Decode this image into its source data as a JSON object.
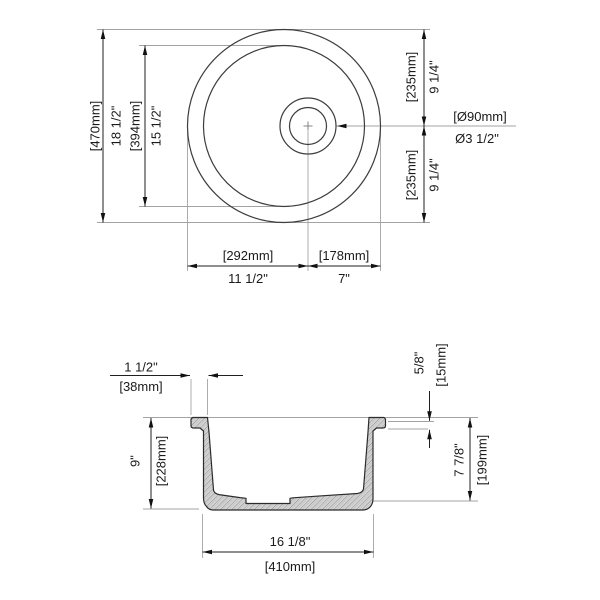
{
  "drawing_type": "sink-dimension-drawing",
  "top_view": {
    "overall_mm": "[470mm]",
    "overall_in": "18 1/2\"",
    "inner_mm": "[394mm]",
    "inner_in": "15 1/2\"",
    "upper_right_mm": "[235mm]",
    "upper_right_in": "9 1/4\"",
    "lower_right_mm": "[235mm]",
    "lower_right_in": "9 1/4\"",
    "drain_mm": "[Ø90mm]",
    "drain_in": "Ø3 1/2\"",
    "bottom_left_mm": "[292mm]",
    "bottom_left_in": "11 1/2\"",
    "bottom_right_mm": "[178mm]",
    "bottom_right_in": "7\""
  },
  "section_view": {
    "lip_in": "1 1/2\"",
    "lip_mm": "[38mm]",
    "height_in": "9\"",
    "height_mm": "[228mm]",
    "rim_in": "5/8\"",
    "rim_mm": "[15mm]",
    "depth_in": "7 7/8\"",
    "depth_mm": "[199mm]",
    "bottom_in": "16 1/8\"",
    "bottom_mm": "[410mm]"
  },
  "colors": {
    "object_line": "#3d3d3d",
    "dimension_line": "#1f1f1f",
    "extension_line": "#a3a3a3",
    "hatch_fill": "#d6d6d6",
    "text": "#1a1a1a"
  }
}
